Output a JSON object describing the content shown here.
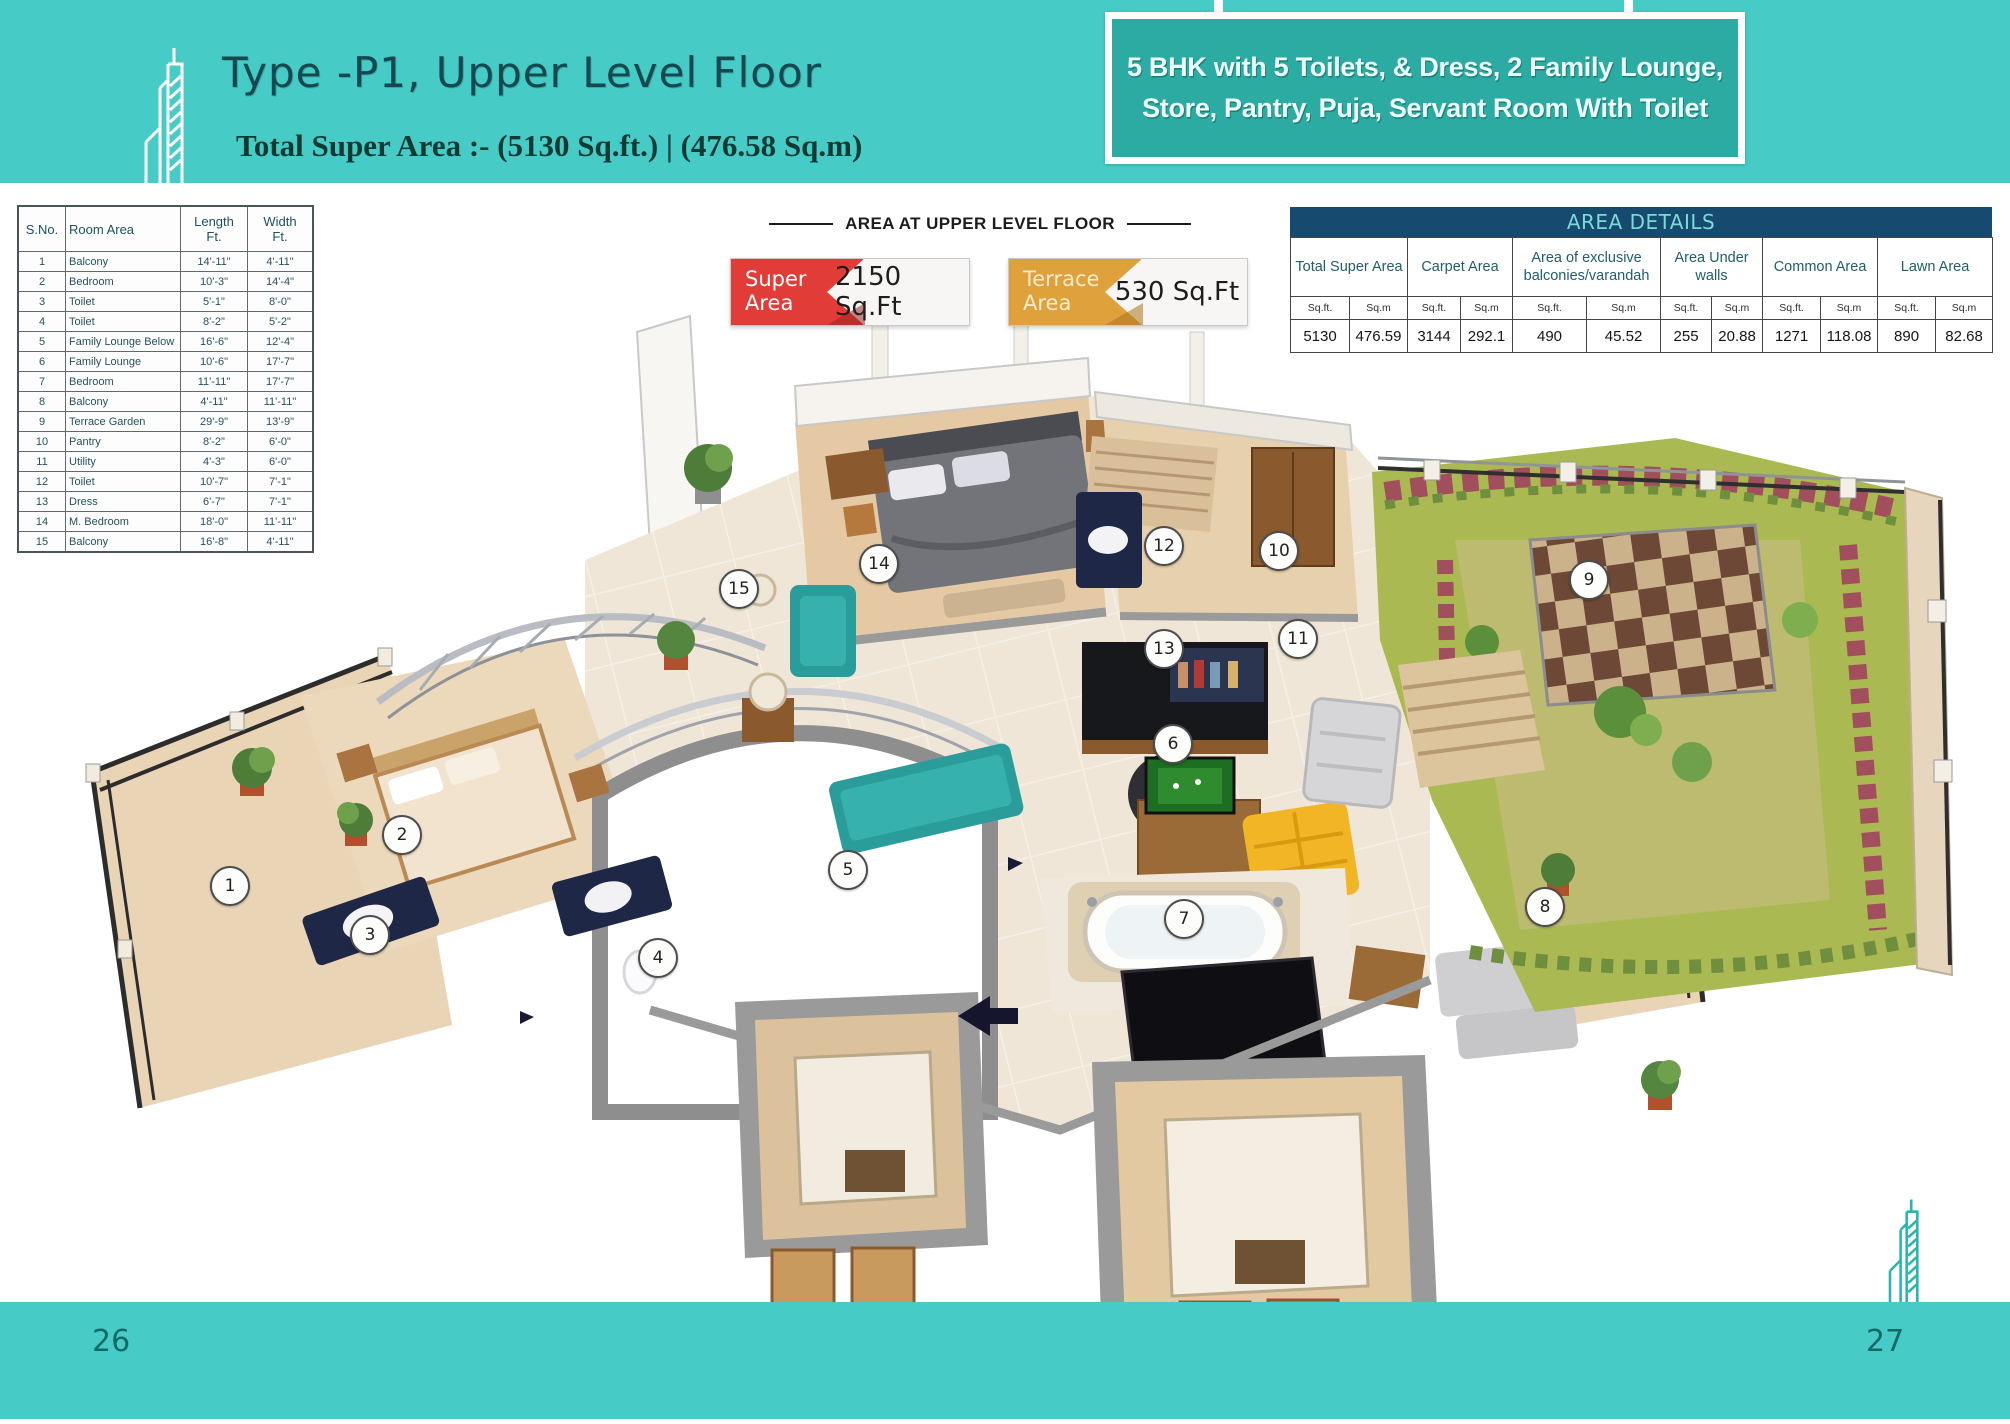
{
  "page": {
    "title": "Type -P1, Upper Level Floor",
    "subtitle": "Total Super Area :- (5130 Sq.ft.) | (476.58 Sq.m)",
    "banner_line1": "5 BHK with 5 Toilets, & Dress, 2 Family Lounge,",
    "banner_line2": "Store, Pantry, Puja, Servant Room With Toilet",
    "page_number_left": "26",
    "page_number_right": "27"
  },
  "room_table": {
    "headers": {
      "sno": "S.No.",
      "room": "Room Area",
      "length": "Length",
      "width": "Width",
      "unit": "Ft."
    },
    "rows": [
      {
        "sno": "1",
        "room": "Balcony",
        "length": "14'-11\"",
        "width": "4'-11\""
      },
      {
        "sno": "2",
        "room": "Bedroom",
        "length": "10'-3\"",
        "width": "14'-4\""
      },
      {
        "sno": "3",
        "room": "Toilet",
        "length": "5'-1\"",
        "width": "8'-0\""
      },
      {
        "sno": "4",
        "room": "Toilet",
        "length": "8'-2\"",
        "width": "5'-2\""
      },
      {
        "sno": "5",
        "room": "Family Lounge Below",
        "length": "16'-6\"",
        "width": "12'-4\""
      },
      {
        "sno": "6",
        "room": "Family Lounge",
        "length": "10'-6\"",
        "width": "17'-7\""
      },
      {
        "sno": "7",
        "room": "Bedroom",
        "length": "11'-11\"",
        "width": "17'-7\""
      },
      {
        "sno": "8",
        "room": "Balcony",
        "length": "4'-11\"",
        "width": "11'-11\""
      },
      {
        "sno": "9",
        "room": "Terrace Garden",
        "length": "29'-9\"",
        "width": "13'-9\""
      },
      {
        "sno": "10",
        "room": "Pantry",
        "length": "8'-2\"",
        "width": "6'-0\""
      },
      {
        "sno": "11",
        "room": "Utility",
        "length": "4'-3\"",
        "width": "6'-0\""
      },
      {
        "sno": "12",
        "room": "Toilet",
        "length": "10'-7\"",
        "width": "7'-1\""
      },
      {
        "sno": "13",
        "room": "Dress",
        "length": "6'-7\"",
        "width": "7'-1\""
      },
      {
        "sno": "14",
        "room": "M. Bedroom",
        "length": "18'-0\"",
        "width": "11'-11\""
      },
      {
        "sno": "15",
        "room": "Balcony",
        "length": "16'-8\"",
        "width": "4'-11\""
      }
    ]
  },
  "plan_header": {
    "label": "AREA AT UPPER LEVEL FLOOR",
    "badges": [
      {
        "label": "Super Area",
        "value": "2150 Sq.Ft",
        "color": "#e23c38"
      },
      {
        "label": "Terrace Area",
        "value": "530 Sq.Ft",
        "color": "#dfa13c"
      }
    ]
  },
  "area_details": {
    "title": "AREA DETAILS",
    "unit_sqft": "Sq.ft.",
    "unit_sqm": "Sq.m",
    "columns": [
      {
        "label": "Total Super Area",
        "sqft": "5130",
        "sqm": "476.59"
      },
      {
        "label": "Carpet Area",
        "sqft": "3144",
        "sqm": "292.1"
      },
      {
        "label": "Area of exclusive balconies/varandah",
        "sqft": "490",
        "sqm": "45.52"
      },
      {
        "label": "Area Under walls",
        "sqft": "255",
        "sqm": "20.88"
      },
      {
        "label": "Common Area",
        "sqft": "1271",
        "sqm": "118.08"
      },
      {
        "label": "Lawn Area",
        "sqft": "890",
        "sqm": "82.68"
      }
    ]
  },
  "floor_plan": {
    "markers": [
      {
        "n": "1",
        "x": 228,
        "y": 884
      },
      {
        "n": "2",
        "x": 400,
        "y": 833
      },
      {
        "n": "3",
        "x": 368,
        "y": 933
      },
      {
        "n": "4",
        "x": 656,
        "y": 956
      },
      {
        "n": "5",
        "x": 846,
        "y": 868
      },
      {
        "n": "6",
        "x": 1171,
        "y": 742
      },
      {
        "n": "7",
        "x": 1182,
        "y": 917
      },
      {
        "n": "8",
        "x": 1543,
        "y": 905
      },
      {
        "n": "9",
        "x": 1587,
        "y": 578
      },
      {
        "n": "10",
        "x": 1277,
        "y": 549
      },
      {
        "n": "11",
        "x": 1296,
        "y": 637
      },
      {
        "n": "12",
        "x": 1162,
        "y": 544
      },
      {
        "n": "13",
        "x": 1162,
        "y": 647
      },
      {
        "n": "14",
        "x": 877,
        "y": 562
      },
      {
        "n": "15",
        "x": 737,
        "y": 587
      }
    ]
  },
  "colors": {
    "band_teal": "#47cbc6",
    "banner_fill": "#2caba3",
    "details_header_navy": "#164a6e",
    "details_header_text": "#7adbd6",
    "badge_red": "#e23c38",
    "badge_orange": "#dfa13c",
    "lawn_green": "#aab952",
    "floor_tan": "#e9d5b6"
  }
}
